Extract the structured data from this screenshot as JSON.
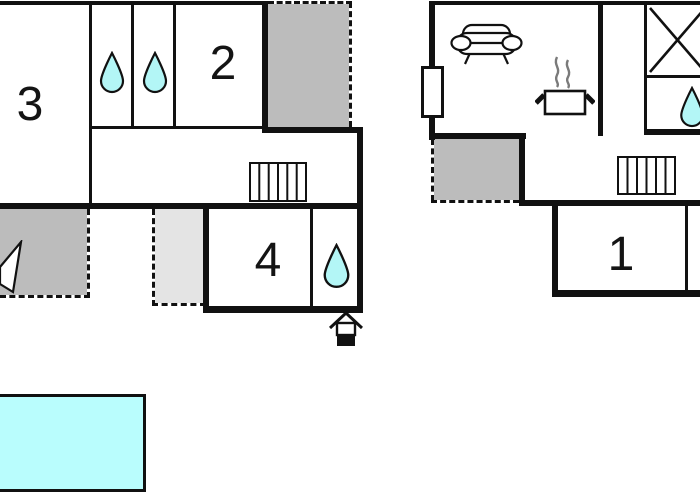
{
  "page_type": "holiday-home floor plan drawing, two floors and a pool",
  "colors": {
    "wall": "#111111",
    "terrace_fill": "#bcbcbc",
    "covered_area_fill": "#e4e4e4",
    "water_drop_fill": "#b3f6f6",
    "pool_fill": "#b9fdfd",
    "steam_stroke": "#7a7a7a"
  },
  "floor_left": {
    "room2_label": "2",
    "room3_label": "3",
    "room4_label": "4"
  },
  "floor_right": {
    "room1_label": "1"
  },
  "icons": {
    "water_drop": "teardrop (bathroom/shower)",
    "stairs": "striped rectangle",
    "sofa": "living-room sofa",
    "cooking_pot": "pot with steam (kitchen)",
    "entrance": "house entrance marker",
    "crossed_box": "box with X",
    "window": "white rectangle on wall",
    "pennant": "cut-off white triangle on terrace"
  }
}
